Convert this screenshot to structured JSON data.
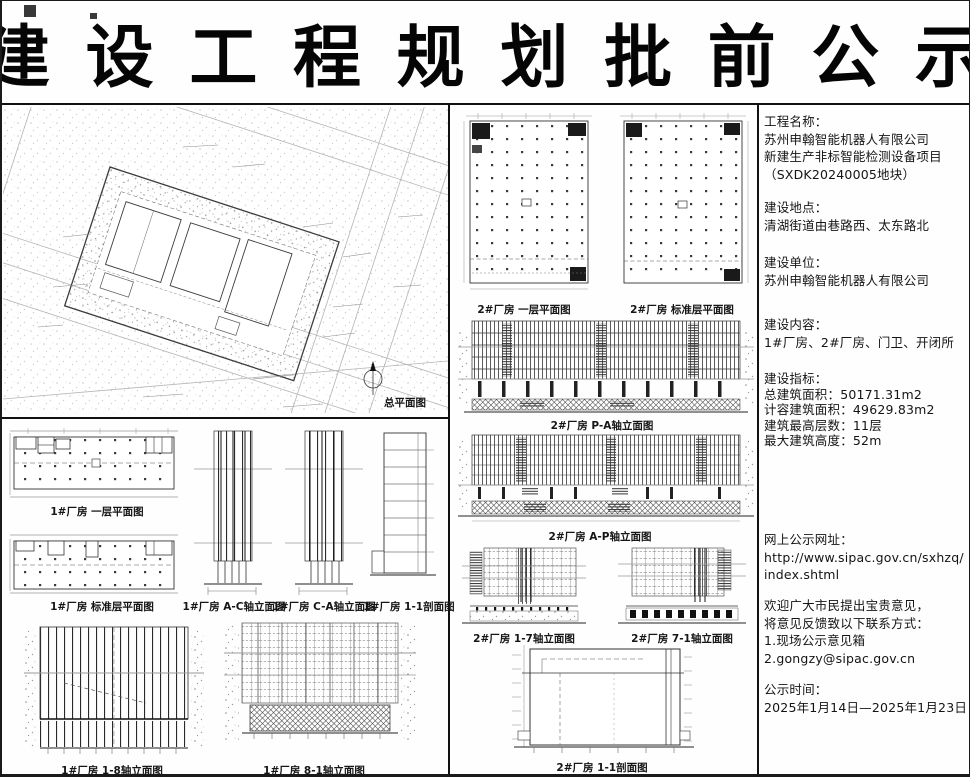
{
  "title": "建 设 工 程 规 划 批 前 公 示",
  "drawings": {
    "site_plan": "总平面图",
    "f1_plan_l1": "1#厂房 一层平面图",
    "f1_plan_std": "1#厂房 标准层平面图",
    "f1_elev_ac": "1#厂房 A-C轴立面图",
    "f1_elev_ca": "1#厂房 C-A轴立面图",
    "f1_section": "1#厂房 1-1剖面图",
    "f1_elev_18": "1#厂房 1-8轴立面图",
    "f1_elev_81": "1#厂房 8-1轴立面图",
    "f2_plan_l1": "2#厂房 一层平面图",
    "f2_plan_std": "2#厂房 标准层平面图",
    "f2_elev_pa": "2#厂房 P-A轴立面图",
    "f2_elev_ap": "2#厂房 A-P轴立面图",
    "f2_elev_17": "2#厂房 1-7轴立面图",
    "f2_elev_71": "2#厂房 7-1轴立面图",
    "f2_section": "2#厂房 1-1剖面图"
  },
  "info": {
    "blocks": [
      {
        "id": "project-name",
        "lines": [
          "工程名称：",
          "苏州申翰智能机器人有限公司",
          "新建生产非标智能检测设备项目",
          "（SXDK20240005地块）"
        ]
      },
      {
        "id": "location",
        "lines": [
          "建设地点：",
          "清湖街道由巷路西、太东路北"
        ]
      },
      {
        "id": "builder",
        "lines": [
          "建设单位：",
          "苏州申翰智能机器人有限公司"
        ]
      },
      {
        "id": "content",
        "lines": [
          "建设内容：",
          "1#厂房、2#厂房、门卫、开闭所"
        ]
      },
      {
        "id": "indicators",
        "lines": [
          "建设指标：",
          "总建筑面积：50171.31m2",
          "计容建筑面积：49629.83m2",
          "建筑最高层数：11层",
          "最大建筑高度：52m"
        ]
      },
      {
        "id": "website",
        "lines": [
          "网上公示网址：",
          "http://www.sipac.gov.cn/sxhzq/",
          "index.shtml"
        ]
      },
      {
        "id": "feedback",
        "lines": [
          "欢迎广大市民提出宝贵意见，",
          "将意见反馈致以下联系方式：",
          "1.现场公示意见箱",
          "2.gongzy@sipac.gov.cn"
        ]
      },
      {
        "id": "period",
        "lines": [
          "公示时间：",
          "2025年1月14日—2025年1月23日"
        ]
      }
    ]
  },
  "colors": {
    "ink": "#111111",
    "drawing_line": "#333333",
    "light_line": "#999999",
    "paper": "#fefefe"
  }
}
